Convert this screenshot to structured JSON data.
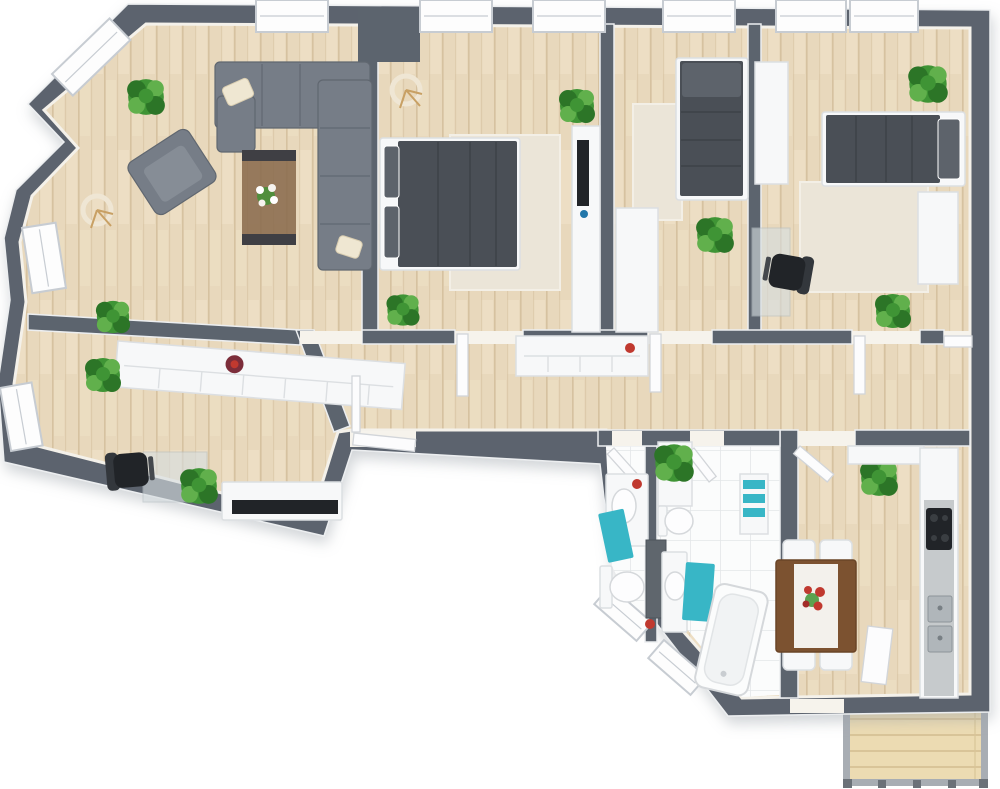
{
  "app": {
    "title": "3D apartment floor plan, top-down render"
  },
  "colors": {
    "wall": "#5c646e",
    "wallEdge": "#eceef0",
    "winFrame": "#c7ccd2",
    "floorWood": "#e8d8bc",
    "plankLine": "#d6c2a0",
    "floorStreak": "#f1e4cc",
    "rug": "#ebe5d8",
    "tile": "#fbfcfc",
    "tileLine": "#e3e6e8",
    "white": "#f7f8f9",
    "whiteShade": "#dcdfe2",
    "sofa": "#767d87",
    "sofaDark": "#606770",
    "darkBedding": "#4a4f56",
    "beddingLight": "#5d636b",
    "plant": "#3f9435",
    "plantDark": "#2c7527",
    "plantLight": "#61b04c",
    "teal": "#38b6c6",
    "tableWood": "#7c5230",
    "runner": "#f3f1ec",
    "deck": "#ecdbb2",
    "deckLine": "#d9c498",
    "black": "#212428",
    "steel": "#b0b6ba",
    "red": "#c0392f",
    "gold": "#c8a064",
    "glass": "#d6dde0"
  },
  "floor_plan": {
    "style": "3d-top-down-render",
    "walls": "dark-gray",
    "window_count": 13,
    "rooms": [
      {
        "name": "living-room",
        "floor": "light-wood",
        "furniture": [
          "gray-corner-sofa",
          "gray-armchair",
          "coffee-table-with-white-flowers",
          "tripod-floor-lamp",
          "potted-plant",
          "potted-plant",
          "cream-throw-pillows"
        ]
      },
      {
        "name": "bedroom-1",
        "floor": "light-wood",
        "rug": "beige-area-rug",
        "furniture": [
          "double-bed-dark-bedding",
          "tripod-floor-lamp",
          "white-media-wall-unit",
          "potted-plant"
        ]
      },
      {
        "name": "bedroom-2-small",
        "floor": "light-wood",
        "rug": "beige-area-rug",
        "furniture": [
          "dark-gray-daybed",
          "white-wardrobe",
          "potted-plant"
        ]
      },
      {
        "name": "bedroom-3",
        "floor": "light-wood",
        "rug": "beige-area-rug",
        "furniture": [
          "single-bed-dark-bedding",
          "glass-desk",
          "black-office-chair",
          "white-bookcase",
          "white-wardrobe",
          "potted-plant",
          "potted-plant"
        ]
      },
      {
        "name": "home-office",
        "floor": "light-wood",
        "furniture": [
          "long-white-sideboard",
          "decor-plate",
          "glass-desk",
          "black-office-chair",
          "white-media-bench",
          "potted-plant",
          "potted-plant"
        ]
      },
      {
        "name": "hallway",
        "floor": "light-wood",
        "furniture": [
          "white-console-cabinet",
          "red-decor-bowl",
          "potted-plant",
          "interior-door-leaves"
        ]
      },
      {
        "name": "wc",
        "floor": "white-tile",
        "furniture": [
          "toilet",
          "white-vanity-with-basin",
          "teal-bath-mat",
          "red-decor"
        ]
      },
      {
        "name": "bathroom",
        "floor": "white-tile",
        "furniture": [
          "bathtub",
          "vanity-with-basin",
          "toilet",
          "teal-towel-shelf",
          "teal-bath-mat",
          "shelf-with-plant"
        ]
      },
      {
        "name": "kitchen",
        "floor": "light-wood",
        "furniture": [
          "counter-run",
          "black-cooktop",
          "double-stainless-sink",
          "brown-dining-table",
          "white-table-runner",
          "red-flower-centerpiece",
          "white-dining-chair",
          "white-dining-chair",
          "white-dining-chair",
          "white-dining-chair",
          "potted-plant"
        ]
      },
      {
        "name": "balcony-deck",
        "floor": "wood-decking",
        "furniture": []
      }
    ]
  }
}
